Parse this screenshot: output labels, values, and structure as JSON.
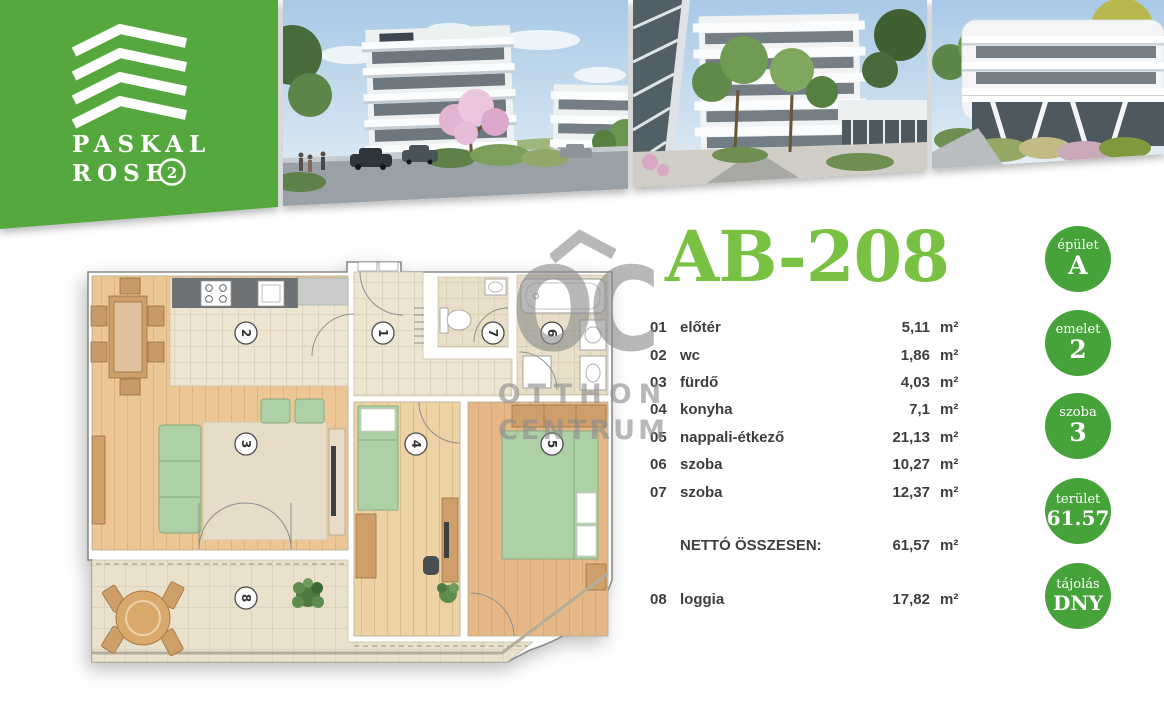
{
  "brand": {
    "name_line1": "PASKAL",
    "name_line2": "ROSE",
    "badge": "2"
  },
  "unit": {
    "title": "AB-208"
  },
  "table": {
    "unit_label": "m²",
    "rooms": [
      {
        "num": "01",
        "name": "előtér",
        "area": "5,11"
      },
      {
        "num": "02",
        "name": "wc",
        "area": "1,86"
      },
      {
        "num": "03",
        "name": "fürdő",
        "area": "4,03"
      },
      {
        "num": "04",
        "name": "konyha",
        "area": "7,1"
      },
      {
        "num": "05",
        "name": "nappali-étkező",
        "area": "21,13"
      },
      {
        "num": "06",
        "name": "szoba",
        "area": "10,27"
      },
      {
        "num": "07",
        "name": "szoba",
        "area": "12,37"
      }
    ],
    "total_label": "NETTÓ ÖSSZESEN:",
    "total_area": "61,57",
    "loggia": {
      "num": "08",
      "name": "loggia",
      "area": "17,82"
    }
  },
  "badges": [
    {
      "label": "épület",
      "value": "A"
    },
    {
      "label": "emelet",
      "value": "2"
    },
    {
      "label": "szoba",
      "value": "3"
    },
    {
      "label": "terület",
      "value": "61.57"
    },
    {
      "label": "tájolás",
      "value": "DNY"
    }
  ],
  "watermark": {
    "abbr": "OC",
    "line1": "OTTHON",
    "line2": "CENTRUM"
  },
  "floor_plan": {
    "room_numbers": [
      "1",
      "2",
      "3",
      "4",
      "5",
      "6",
      "7",
      "8"
    ]
  },
  "colors": {
    "brand_green": "#55a83e",
    "badge_green": "#46a339",
    "title_green": "#79c143",
    "text_dark": "#3e3e3e",
    "watermark_gray": "#8d8d8d"
  }
}
